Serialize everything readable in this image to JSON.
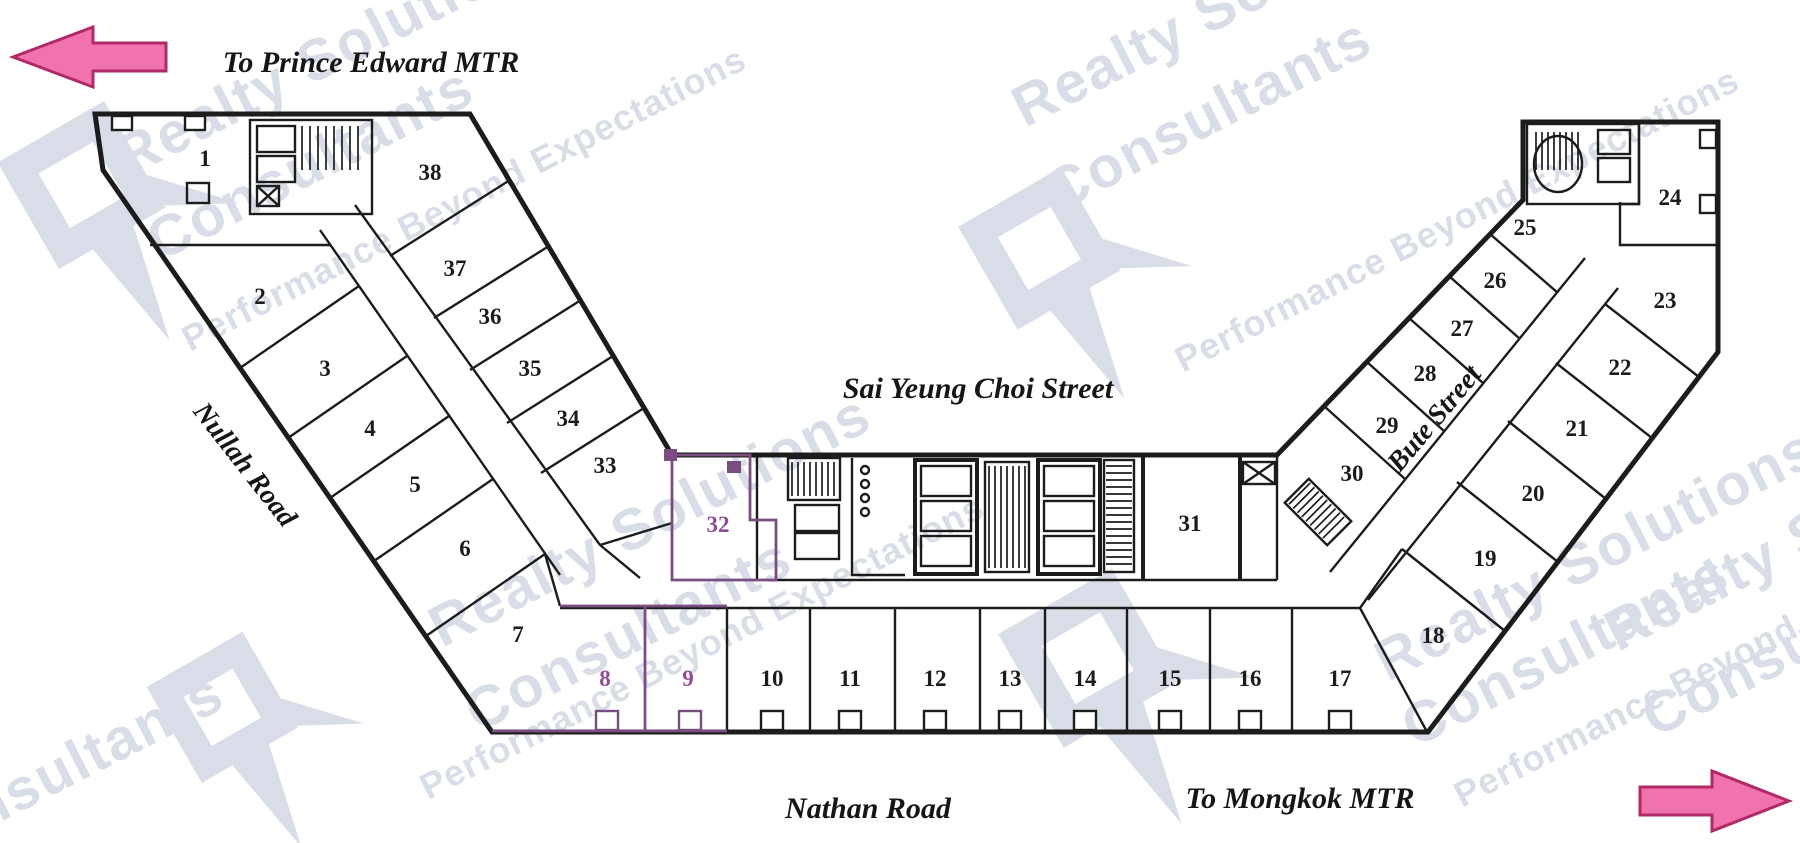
{
  "plan_title": "office floor plan",
  "directions": {
    "left_label": "To Prince Edward MTR",
    "right_label": "To Mongkok MTR"
  },
  "streets": {
    "top": "Sai Yeung Choi Street",
    "bottom": "Nathan Road",
    "left": "Nullah Road",
    "right": "Bute Street"
  },
  "units": [
    "1",
    "2",
    "3",
    "4",
    "5",
    "6",
    "7",
    "8",
    "9",
    "10",
    "11",
    "12",
    "13",
    "14",
    "15",
    "16",
    "17",
    "18",
    "19",
    "20",
    "21",
    "22",
    "23",
    "24",
    "25",
    "26",
    "27",
    "28",
    "29",
    "30",
    "31",
    "32",
    "33",
    "34",
    "35",
    "36",
    "37",
    "38"
  ],
  "highlighted_units": [
    "8",
    "9",
    "32"
  ],
  "watermark": {
    "brand_line1": "Realty Solutions",
    "brand_line2": "Consultants",
    "tagline": "Performance Beyond Expectations"
  },
  "colors": {
    "highlight": "#7a4d80",
    "highlight-text": "#8f4d95",
    "arrow-fill": "#f173ae",
    "arrow-stroke": "#b02a68",
    "wm": "#d8dde8",
    "line": "#1c1c1c"
  }
}
